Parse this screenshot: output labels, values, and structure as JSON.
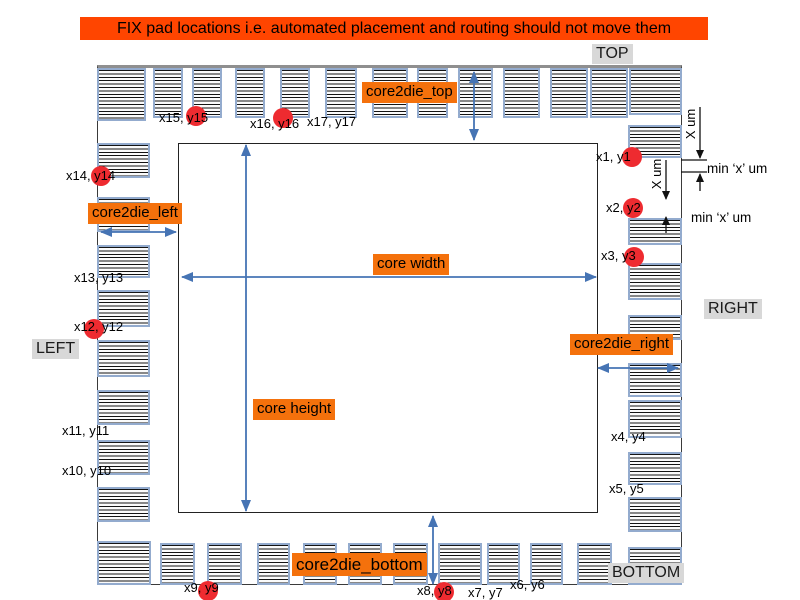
{
  "banner": {
    "text": "FIX pad locations i.e. automated placement and routing should not move them"
  },
  "side_labels": {
    "top": "TOP",
    "left": "LEFT",
    "right": "RIGHT",
    "bottom": "BOTTOM"
  },
  "dim_labels": {
    "core2die_top": "core2die_top",
    "core2die_left": "core2die_left",
    "core2die_right": "core2die_right",
    "core2die_bottom": "core2die_bottom",
    "core_width": "core width",
    "core_height": "core height"
  },
  "annotations": {
    "x_um_1": "X um",
    "x_um_2": "X um",
    "min_x_um_1": "min ‘x’ um",
    "min_x_um_2": "min ‘x’ um"
  },
  "colors": {
    "banner_bg": "#ff4500",
    "label_bg": "#f4710c",
    "gray_bg": "#d8d8d8",
    "pad_border": "#93abce",
    "arrow_blue": "#4674b4",
    "annotation_black": "#111111",
    "fix_circle_red": "#ee2b30"
  },
  "pads": {
    "top": [
      [
        97,
        68,
        49,
        53
      ],
      [
        153,
        68,
        30,
        50
      ],
      [
        192,
        68,
        30,
        50
      ],
      [
        235,
        68,
        30,
        50
      ],
      [
        280,
        68,
        30,
        50
      ],
      [
        325,
        68,
        32,
        50
      ],
      [
        372,
        68,
        36,
        50
      ],
      [
        417,
        68,
        31,
        50
      ],
      [
        458,
        68,
        35,
        50
      ],
      [
        503,
        68,
        37,
        50
      ],
      [
        550,
        68,
        38,
        50
      ],
      [
        590,
        68,
        38,
        50
      ],
      [
        629,
        68,
        53,
        47
      ]
    ],
    "bottom": [
      [
        97,
        541,
        54,
        44
      ],
      [
        160,
        543,
        35,
        42
      ],
      [
        207,
        543,
        35,
        42
      ],
      [
        257,
        543,
        33,
        42
      ],
      [
        303,
        543,
        34,
        42
      ],
      [
        348,
        543,
        34,
        42
      ],
      [
        393,
        543,
        35,
        42
      ],
      [
        438,
        543,
        44,
        42
      ],
      [
        487,
        543,
        33,
        42
      ],
      [
        530,
        543,
        33,
        42
      ],
      [
        577,
        543,
        35,
        42
      ],
      [
        628,
        547,
        54,
        38
      ]
    ],
    "left": [
      [
        97,
        143,
        53,
        35
      ],
      [
        97,
        197,
        53,
        35
      ],
      [
        97,
        245,
        53,
        33
      ],
      [
        97,
        290,
        53,
        37
      ],
      [
        97,
        340,
        53,
        37
      ],
      [
        97,
        390,
        53,
        35
      ],
      [
        97,
        440,
        53,
        35
      ],
      [
        97,
        487,
        53,
        35
      ]
    ],
    "right": [
      [
        628,
        125,
        54,
        33
      ],
      [
        628,
        218,
        54,
        27
      ],
      [
        628,
        263,
        54,
        37
      ],
      [
        628,
        315,
        54,
        25
      ],
      [
        628,
        363,
        54,
        34
      ],
      [
        628,
        400,
        54,
        38
      ],
      [
        628,
        452,
        54,
        33
      ],
      [
        628,
        497,
        54,
        35
      ]
    ]
  },
  "pad_labels": [
    {
      "id": "x1",
      "text": "x1, y1",
      "x": 596,
      "y": 150
    },
    {
      "id": "x2",
      "text": "x2, y2",
      "x": 606,
      "y": 201
    },
    {
      "id": "x3",
      "text": "x3, y3",
      "x": 601,
      "y": 249
    },
    {
      "id": "x4",
      "text": "x4, y4",
      "x": 611,
      "y": 430
    },
    {
      "id": "x5",
      "text": "x5, y5",
      "x": 609,
      "y": 482
    },
    {
      "id": "x6",
      "text": "x6, y6",
      "x": 510,
      "y": 578
    },
    {
      "id": "x7",
      "text": "x7, y7",
      "x": 468,
      "y": 586
    },
    {
      "id": "x8",
      "text": "x8, y8",
      "x": 417,
      "y": 584
    },
    {
      "id": "x9",
      "text": "x9, y9",
      "x": 184,
      "y": 581
    },
    {
      "id": "x10",
      "text": "x10, y10",
      "x": 62,
      "y": 464
    },
    {
      "id": "x11",
      "text": "x11, y11",
      "x": 62,
      "y": 424
    },
    {
      "id": "x12",
      "text": "x12, y12",
      "x": 74,
      "y": 320
    },
    {
      "id": "x13",
      "text": "x13, y13",
      "x": 74,
      "y": 271
    },
    {
      "id": "x14",
      "text": "x14, y14",
      "x": 66,
      "y": 169
    },
    {
      "id": "x15",
      "text": "x15, y15",
      "x": 159,
      "y": 111
    },
    {
      "id": "x16",
      "text": "x16, y16",
      "x": 250,
      "y": 117
    },
    {
      "id": "x17",
      "text": "x17, y17",
      "x": 307,
      "y": 115
    }
  ],
  "fix_circles": [
    {
      "id": "x1",
      "cx": 632,
      "cy": 157
    },
    {
      "id": "x2",
      "cx": 633,
      "cy": 208
    },
    {
      "id": "x3",
      "cx": 634,
      "cy": 257
    },
    {
      "id": "x8",
      "cx": 444,
      "cy": 592
    },
    {
      "id": "x9",
      "cx": 208,
      "cy": 591
    },
    {
      "id": "x12",
      "cx": 94,
      "cy": 329
    },
    {
      "id": "x14",
      "cx": 101,
      "cy": 176
    },
    {
      "id": "x15",
      "cx": 196,
      "cy": 116
    },
    {
      "id": "x16",
      "cx": 283,
      "cy": 118
    }
  ],
  "arrows": [
    {
      "name": "core2die-top-arrow",
      "color": "blue",
      "x1": 474,
      "y1": 72,
      "x2": 474,
      "y2": 140,
      "heads": "both"
    },
    {
      "name": "core2die-left-arrow",
      "color": "blue",
      "x1": 101,
      "y1": 232,
      "x2": 176,
      "y2": 232,
      "heads": "both"
    },
    {
      "name": "core2die-right-arrow",
      "color": "blue",
      "x1": 598,
      "y1": 368,
      "x2": 678,
      "y2": 368,
      "heads": "both"
    },
    {
      "name": "core2die-bottom-arrow",
      "color": "blue",
      "x1": 433,
      "y1": 516,
      "x2": 433,
      "y2": 584,
      "heads": "both"
    },
    {
      "name": "core-width-arrow",
      "color": "blue",
      "x1": 182,
      "y1": 277,
      "x2": 596,
      "y2": 277,
      "heads": "both"
    },
    {
      "name": "core-height-arrow",
      "color": "blue",
      "x1": 246,
      "y1": 145,
      "x2": 246,
      "y2": 511,
      "heads": "both"
    },
    {
      "name": "x-um-arrow-1",
      "color": "black",
      "x1": 700,
      "y1": 107,
      "x2": 700,
      "y2": 158,
      "heads": "end"
    },
    {
      "name": "min-x-up-arrow-1",
      "color": "black",
      "x1": 700,
      "y1": 191,
      "x2": 700,
      "y2": 174,
      "heads": "end"
    },
    {
      "name": "x-um-arrow-2",
      "color": "black",
      "x1": 666,
      "y1": 160,
      "x2": 666,
      "y2": 199,
      "heads": "end"
    },
    {
      "name": "min-x-up-arrow-2",
      "color": "black",
      "x1": 666,
      "y1": 233,
      "x2": 666,
      "y2": 217,
      "heads": "end"
    }
  ],
  "ticks": [
    {
      "name": "min-x-tick-top",
      "x1": 681,
      "y1": 160,
      "x2": 707,
      "y2": 160
    },
    {
      "name": "min-x-tick-bottom",
      "x1": 681,
      "y1": 172,
      "x2": 707,
      "y2": 172
    }
  ]
}
